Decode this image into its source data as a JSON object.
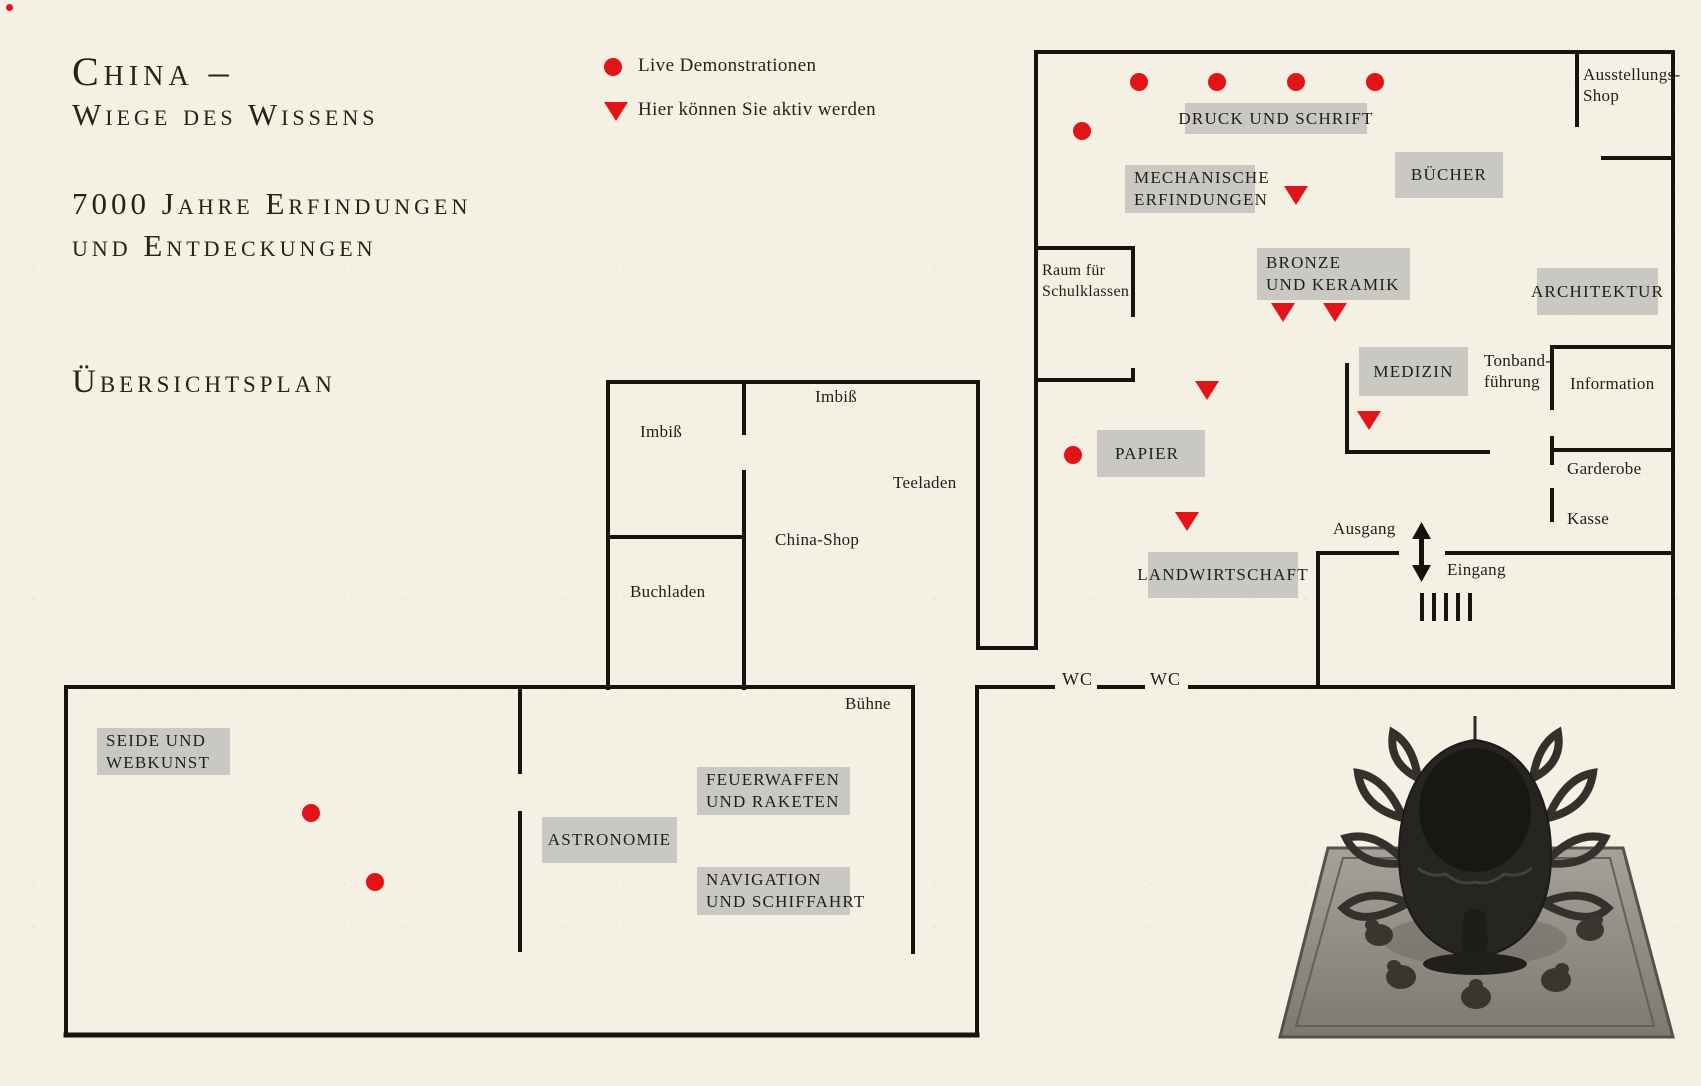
{
  "page": {
    "title_line1": "China –",
    "title_line2": "Wiege des Wissens",
    "title_line3": "7000 Jahre Erfindungen",
    "title_line4": "und Entdeckungen",
    "title_line5": "Übersichtsplan"
  },
  "legend": {
    "dot_label": "Live Demonstrationen",
    "triangle_label": "Hier können Sie aktiv werden"
  },
  "plan": {
    "labels": {
      "druck": "DRUCK UND SCHRIFT",
      "mechanische": {
        "line1": "MECHANISCHE",
        "line2": "ERFINDUNGEN"
      },
      "buecher": "BÜCHER",
      "bronze": {
        "line1": "BRONZE",
        "line2": "UND KERAMIK"
      },
      "architektur": "ARCHITEKTUR",
      "medizin": "MEDIZIN",
      "papier": "PAPIER",
      "landwirtschaft": "LANDWIRTSCHAFT",
      "seide": {
        "line1": "SEIDE UND",
        "line2": "WEBKUNST"
      },
      "feuerwaffen": {
        "line1": "FEUERWAFFEN",
        "line2": "UND RAKETEN"
      },
      "astronomie": "ASTRONOMIE",
      "navigation": {
        "line1": "NAVIGATION",
        "line2": "UND SCHIFFAHRT"
      },
      "ausstellungsshop": {
        "line1": "Ausstellungs-",
        "line2": "Shop"
      },
      "raum_schulklassen": {
        "line1": "Raum für",
        "line2": "Schulklassen"
      },
      "tonband": {
        "line1": "Tonband-",
        "line2": "führung"
      },
      "information": "Information",
      "garderobe": "Garderobe",
      "kasse": "Kasse",
      "ausgang": "Ausgang",
      "eingang": "Eingang",
      "imbiss_left": "Imbiß",
      "imbiss_top": "Imbiß",
      "teeladen": "Teeladen",
      "china_shop": "China-Shop",
      "buchladen": "Buchladen",
      "buehne": "Bühne",
      "wc": "WC"
    }
  },
  "markers": {
    "live_demo_dots": [
      [
        1139,
        82
      ],
      [
        1217,
        82
      ],
      [
        1296,
        82
      ],
      [
        1375,
        82
      ],
      [
        1082,
        131
      ],
      [
        1073,
        455
      ],
      [
        311,
        813
      ],
      [
        375,
        882
      ]
    ],
    "active_triangles": [
      [
        1296,
        196
      ],
      [
        1283,
        313
      ],
      [
        1335,
        313
      ],
      [
        1207,
        391
      ],
      [
        1369,
        421
      ],
      [
        1187,
        522
      ]
    ]
  },
  "colors": {
    "red": "#e31417",
    "ink": "#26221a",
    "wall": "#17140e",
    "label_box": "#c9c8c2",
    "paper": "#f4f0e4"
  }
}
